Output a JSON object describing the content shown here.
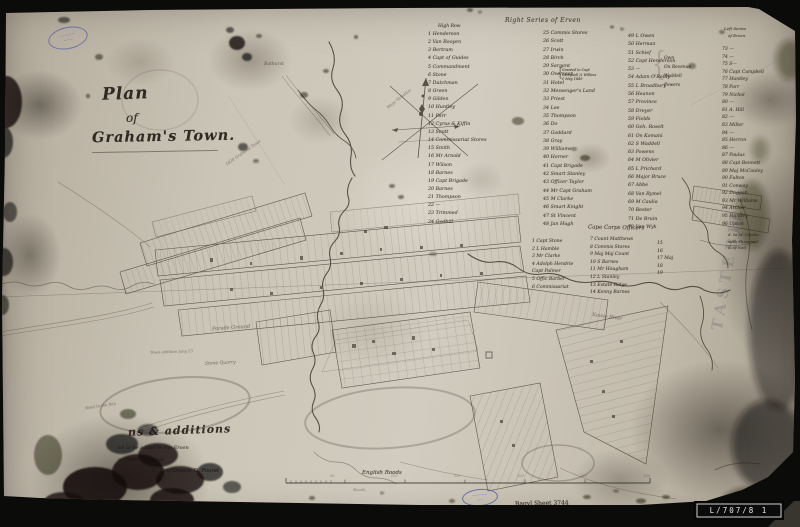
{
  "photo": {
    "archive_label": "L/707/8 1",
    "sheet_note": "Bagvl Sheet 3744",
    "ghost_text": "TASTEBIL"
  },
  "title": {
    "line1": "Plan",
    "line2": "of",
    "line3": "Graham's Town."
  },
  "pencil_note": "1820 Grahams Town",
  "compass": {
    "label": "Magc Variation"
  },
  "map_labels": {
    "parade": "Parade Ground",
    "quarry": "Stone Quarry",
    "river": "Kowie River",
    "bathurst": "Bathurst",
    "addition": "Town addition Jany 53",
    "road": "Road to the Bay"
  },
  "lists": {
    "main_header": "Right Series of Erven",
    "brace_open": "{",
    "brace_close": "{",
    "col1_header": "High Row",
    "col1": [
      "1  Henderson",
      "2  Van Rooyen",
      "3  Bertram",
      "4  Capt of Guides",
      "5  Commandment",
      "6  Stone",
      "7  Dutchman",
      "8  Green",
      "9  Gilden",
      "10  Huntley",
      "11  Parr",
      "12  Cyrus & Kiffin",
      "13  Scott",
      "14  Commissariat Stores",
      "15  Smith",
      "16  Mr Arnold",
      "17  Wilson",
      "18  Barnes",
      "19  Capt Brigade",
      "20  Barnes",
      "21  Thompson",
      "22  —",
      "23  Trimmed",
      "24  Godbill"
    ],
    "col2": [
      "25  Commis Stores",
      "26  Scott",
      "27  Irwin",
      "28  Birch",
      "29  Sargent",
      "30  Overseer",
      "31  Hotel",
      "32  Messenger's Land",
      "33  Priest",
      "34  Lee",
      "35  Thompson",
      "36  Do",
      "37  Goddard",
      "38  Gray",
      "39  Williams",
      "40  Horner",
      "41  Capt Brigade",
      "42  Smart Stanley",
      "43  Officer Taylor",
      "44  Mr Capt Graham",
      "45  M Clarke",
      "46  Smart Knight",
      "47  St Vincent",
      "48  Jan Hugh"
    ],
    "note_col2": [
      "Granted to Capt",
      "Campbell & Wilkins",
      "1 May 1849"
    ],
    "col3": [
      "49  L Owen",
      "50  Herman",
      "51  Schief",
      "52  Capt Henderson",
      "53  —",
      "54  Adam O'Reilly",
      "55  L Broadbury",
      "56  Heanon",
      "57  Province",
      "58  Dreyer",
      "59  Fields",
      "60  Geh. Roselt",
      "61  On Komani",
      "62  S Waddell",
      "63  Powens",
      "64  M Olivier",
      "65  L Prichard",
      "66  Major Bruce",
      "67  Abbe",
      "68  Van Rymel",
      "69  M Caulia",
      "70  Bester",
      "71  De Bruin",
      "72  Van Wyk"
    ],
    "col3b": [
      "Own",
      "On Revenue",
      "Waddell",
      "Powers"
    ],
    "col4_header1": "Left Series",
    "col4_header2": "of Erven",
    "col4": [
      "73  —",
      "74  —",
      "75  S—",
      "76  Capt Campbell",
      "77  Huntley",
      "78  Parr",
      "79  Nichol",
      "80  —",
      "81  A. Hill",
      "82  —",
      "83  Miller",
      "84  —",
      "85  Herron",
      "86  —",
      "87  Paulus",
      "88  Capt Bennett",
      "89  Maj McCauley",
      "90  Fulton",
      "91  Conway",
      "92  Duggan",
      "93  Mr Williams",
      "94  Archer",
      "95  Huntley",
      "96  Upton"
    ],
    "col4_note": [
      "d. to M. Clarke",
      "with Shaw and",
      "S. O'Neil"
    ]
  },
  "officers": {
    "header": "Cape Corps Officers",
    "col1": [
      "1  Capt Stone",
      "2  L Hamble",
      "3  Mr Clarke",
      "4  Adolph Hendrie",
      "    Capt Palmer",
      "5  Offic Barber",
      "6  Commissariat"
    ],
    "col2": [
      "7  Count Matthews",
      "8  Commis Stores",
      "9  Maj Maj Count",
      "10  S Barnes",
      "11  Mr Hougham",
      "12  L Stanley",
      "13  Estate Ridge",
      "14  Kenny Barnes"
    ],
    "col3": [
      "15",
      "16",
      "17  Maj",
      "18",
      "19"
    ]
  },
  "notes": {
    "line1": "ns & additions",
    "line2": "ed to be added to the Erven",
    "line3": "on from the Erven",
    "line4": "C. Courthouse   D. Pound"
  },
  "scale": {
    "label": "English Roods",
    "sub_label": "Roods",
    "ticks": [
      "50",
      "100",
      "150",
      "200",
      "250",
      "300"
    ]
  },
  "stamps": {
    "s1line1": "~~~~~",
    "s1line2": "~~~",
    "s2line1": "~~~~~",
    "s2line2": "~~"
  },
  "colors": {
    "paper": "#cdc6b8",
    "ink": "#3b332a",
    "stamp_blue": "#5c62ac",
    "label_bg": "#0b0b0b",
    "label_text": "#e9e9e7"
  }
}
